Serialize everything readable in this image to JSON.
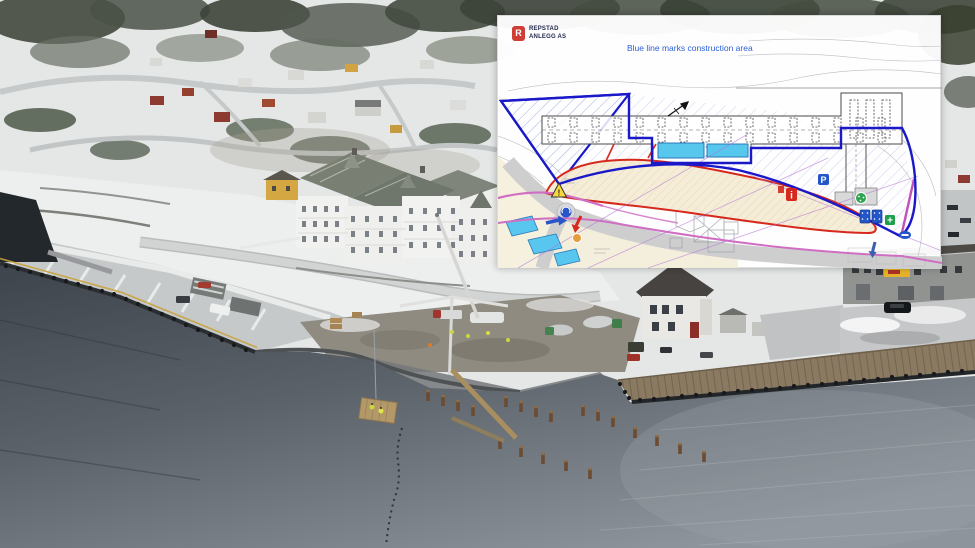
{
  "plan_overlay": {
    "logo": {
      "line1": "REPSTAD",
      "line2": "ANLEGG AS",
      "mark_glyph": "R"
    },
    "title": "Blue line marks construction area",
    "icons": {
      "parking": "P",
      "info": "i",
      "warning": "!",
      "first_aid": "+"
    },
    "colors": {
      "logo_red": "#cf3d35",
      "title_blue": "#2b5ed6",
      "construction_boundary_blue": "#1a18c8",
      "rig_boundary_red": "#d6281c",
      "water_cyan": "#57c7ee",
      "utility_magenta": "#c95fc4"
    }
  }
}
